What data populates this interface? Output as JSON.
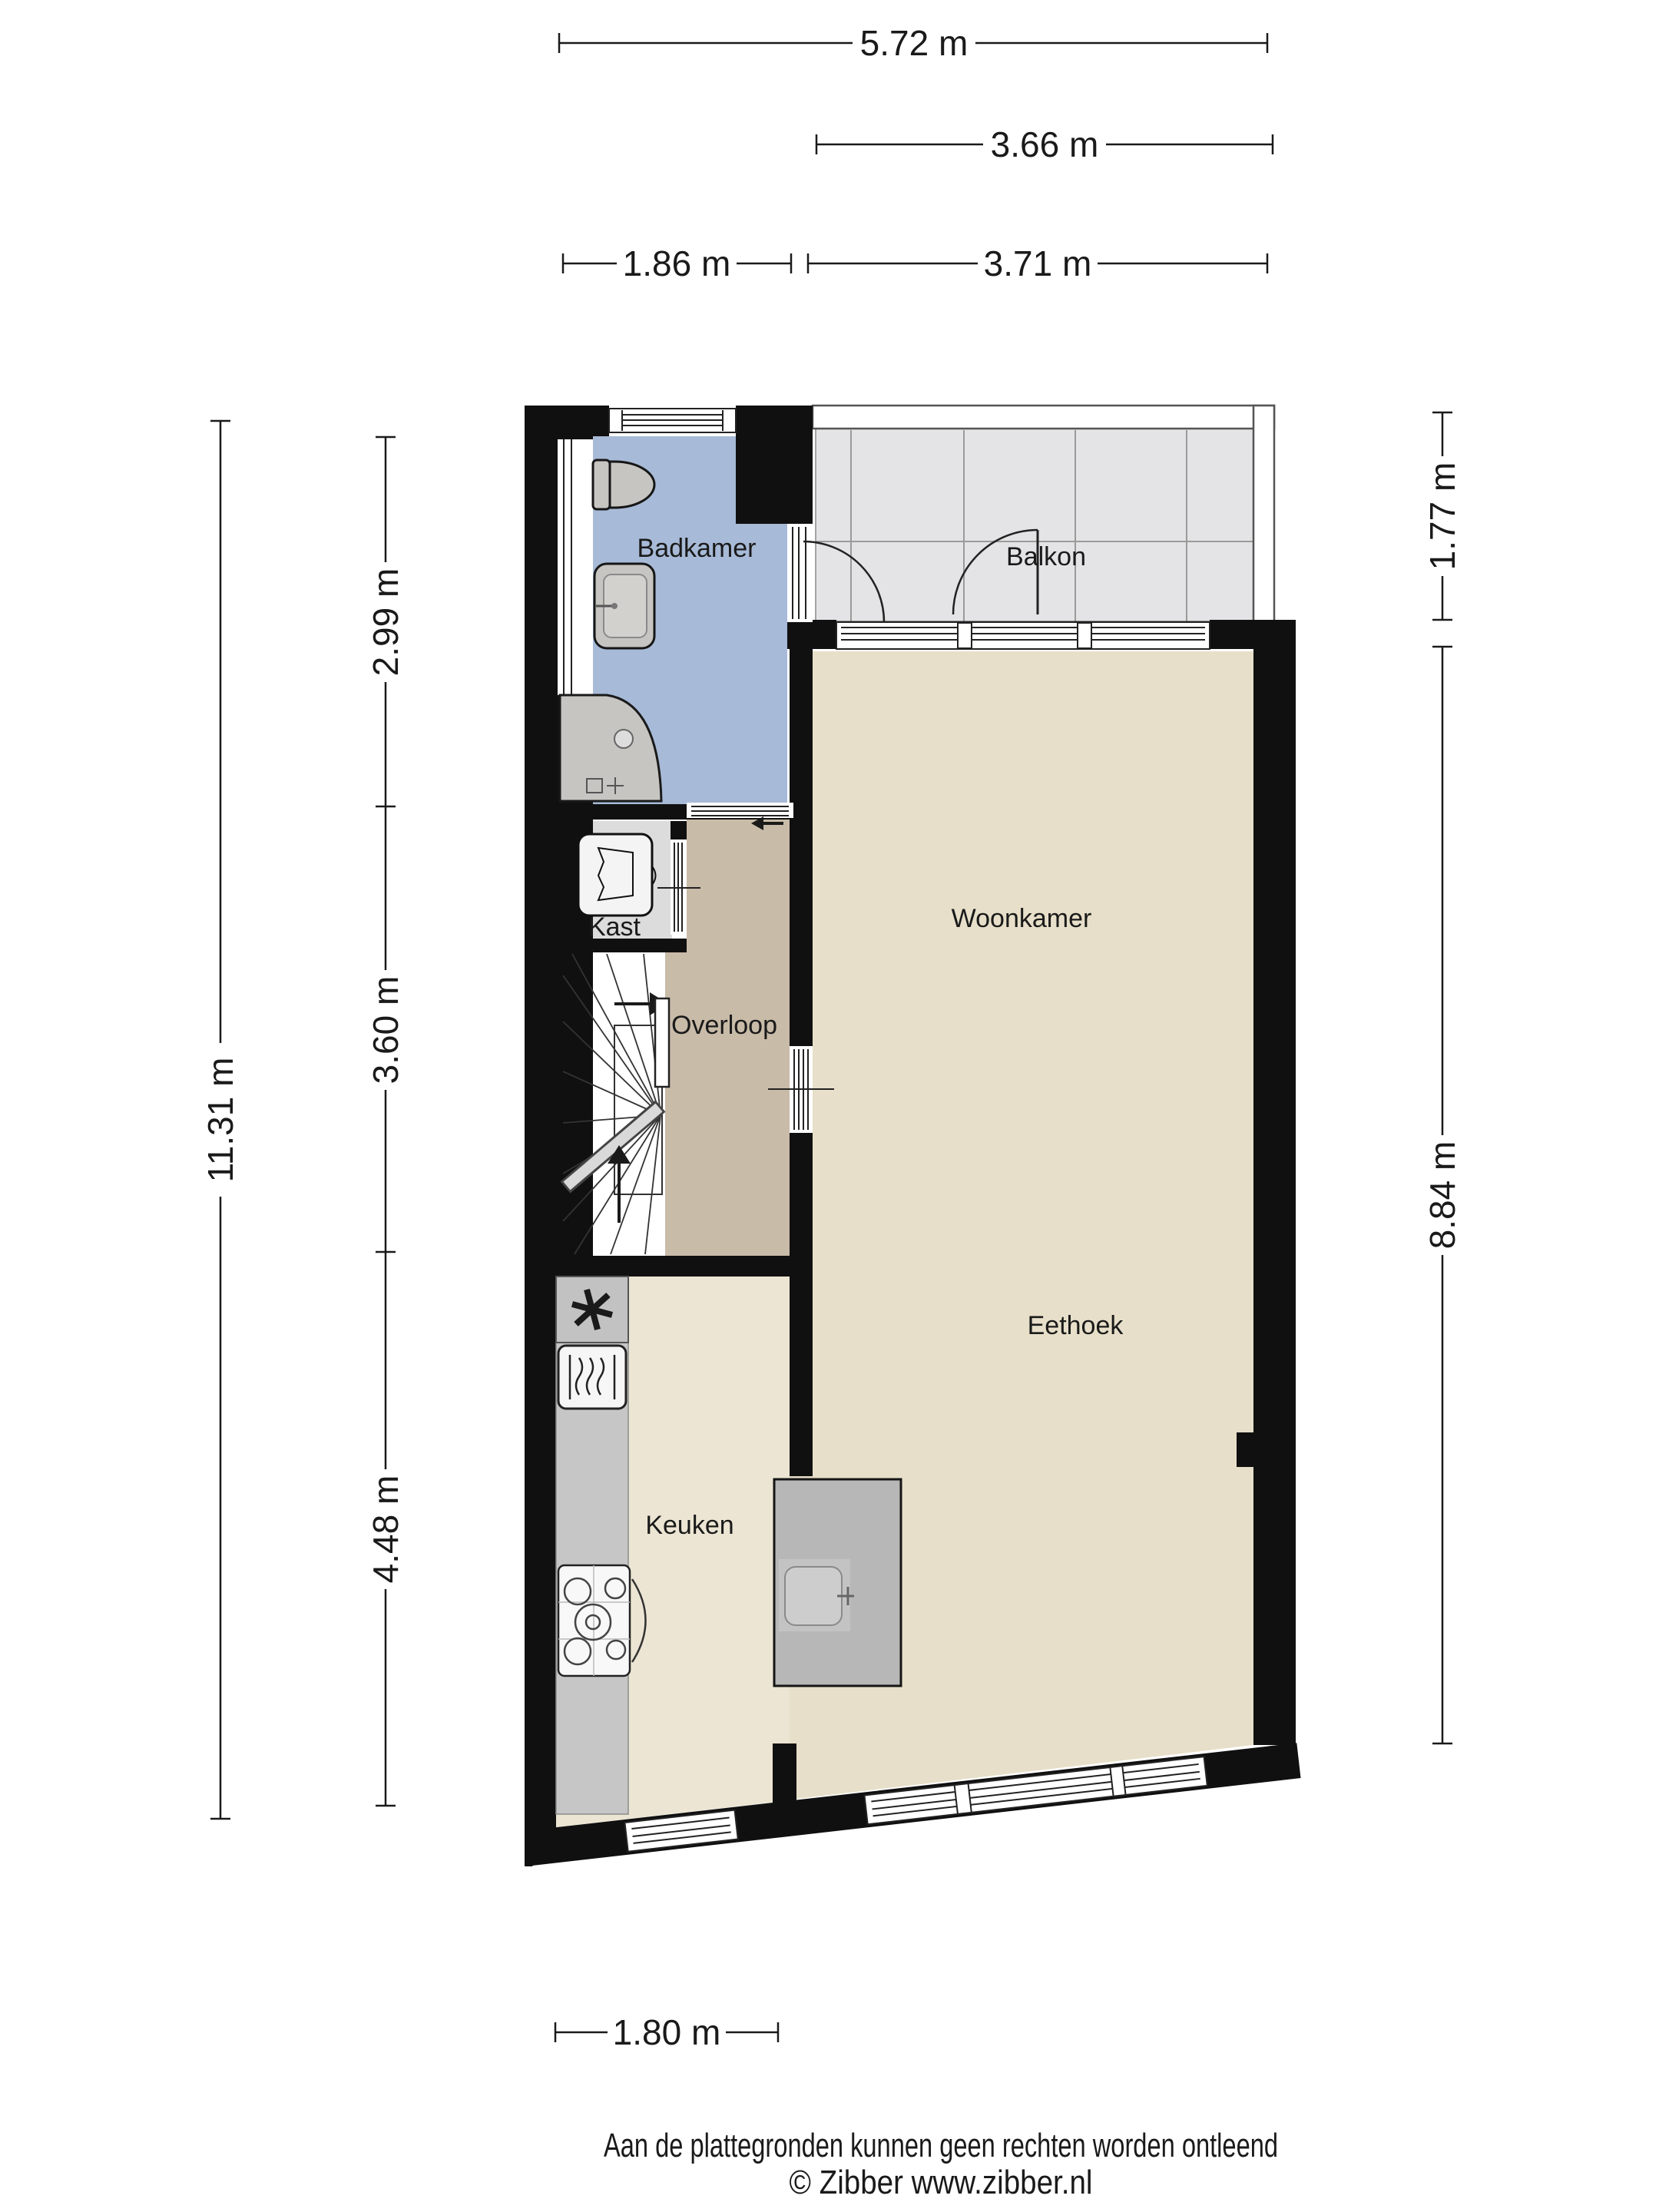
{
  "plan": {
    "type": "floorplan",
    "floor_description": "Apartment floor with bathroom, landing, kitchen, living/dining room and balcony"
  },
  "rooms": {
    "badkamer": "Badkamer",
    "balkon": "Balkon",
    "woonkamer": "Woonkamer",
    "eethoek": "Eethoek",
    "overloop": "Overloop",
    "kast": "Kast",
    "keuken": "Keuken"
  },
  "dimensions": {
    "top_total": "5.72 m",
    "top_balcony": "3.66 m",
    "top_left": "1.86 m",
    "top_right": "3.71 m",
    "left_total": "11.31 m",
    "left_upper": "2.99 m",
    "left_middle": "3.60 m",
    "left_lower": "4.48 m",
    "right_upper": "1.77 m",
    "right_lower": "8.84 m",
    "bottom": "1.80 m"
  },
  "footer": {
    "disclaimer": "Aan de plattegronden kunnen geen rechten worden ontleend",
    "copyright": "© Zibber www.zibber.nl"
  },
  "colors": {
    "wall": "#101010",
    "bathroom_floor": "#a7bad7",
    "living_floor": "#e7dfc9",
    "kitchen_floor": "#ece5d3",
    "landing_floor": "#c8bba8",
    "closet_floor": "#dcdcdc",
    "balcony_floor": "#e4e4e6",
    "counter": "#c6c6c6",
    "island": "#b7b7b7",
    "dimension_ink": "#1a1a1a"
  }
}
